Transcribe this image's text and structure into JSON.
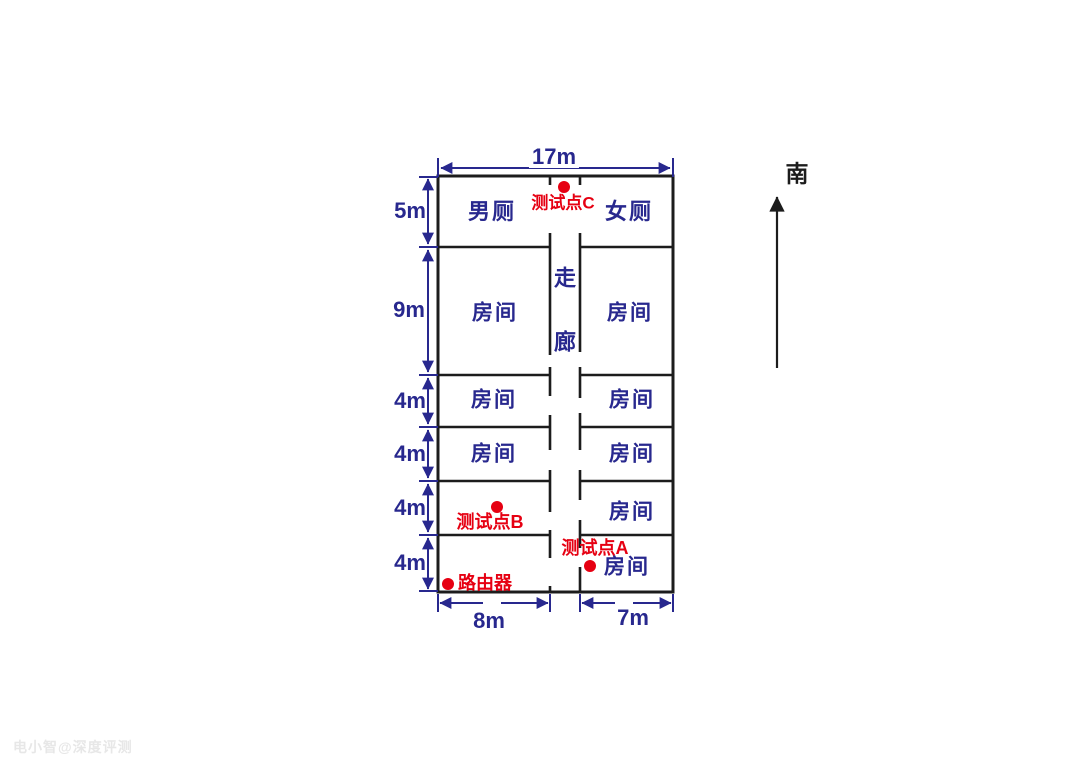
{
  "colors": {
    "wall": "#1c1c1c",
    "dimension_and_room_text": "#28288e",
    "marker_red": "#e60012",
    "compass_black": "#1c1c1c",
    "watermark_gray": "#e7e7e7"
  },
  "floor_plan": {
    "rooms": {
      "men_toilet": "男厕",
      "women_toilet": "女厕",
      "corridor": "走廊",
      "room": "房间"
    },
    "dimensions": {
      "total_width": "17m",
      "rows": [
        "5m",
        "9m",
        "4m",
        "4m",
        "4m",
        "4m"
      ],
      "bottom_left_width": "8m",
      "bottom_right_width": "7m"
    },
    "markers": {
      "test_point_a": "测试点A",
      "test_point_b": "测试点B",
      "test_point_c": "测试点C",
      "router": "路由器"
    },
    "compass": {
      "south": "南"
    }
  },
  "watermark": {
    "text": "电小智@深度评测"
  }
}
